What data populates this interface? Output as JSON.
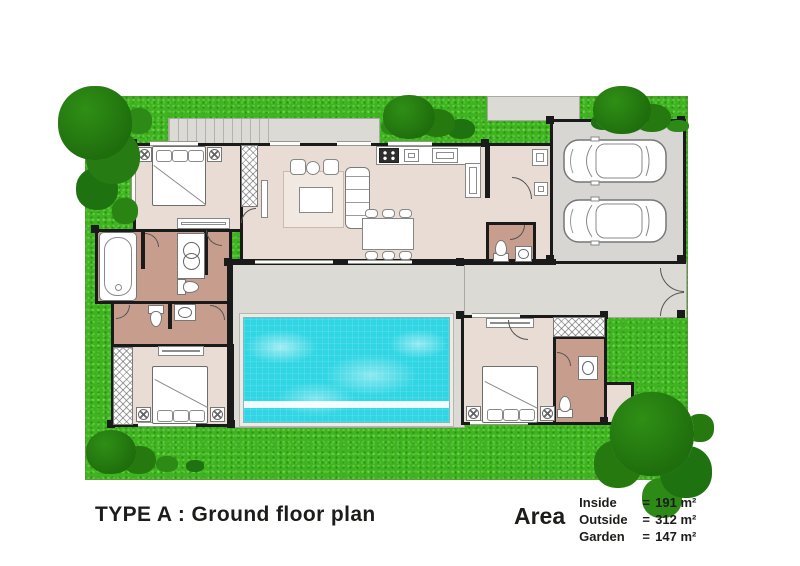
{
  "title": "TYPE A : Ground floor plan",
  "legend": {
    "label": "Area",
    "equals": "=",
    "rows": [
      {
        "name": "Inside",
        "value": "191 m²"
      },
      {
        "name": "Outside",
        "value": "312 m²"
      },
      {
        "name": "Garden",
        "value": "147 m²"
      }
    ]
  },
  "colors": {
    "grass": "#3eb51e",
    "tree_mid": "#2f8f15",
    "tree_dark": "#1f6e0d",
    "pool_water": "#31d6e4",
    "floor": "#e9dcd4",
    "bath_floor": "#c79e8e",
    "deck": "#dbdad5",
    "garage_floor": "#d7d6d2",
    "rug": "#f0e8e1",
    "wall": "#1a1a1a",
    "text": "#1c1c1a"
  },
  "icons": {
    "bedrooms": 3,
    "bathrooms": 4,
    "cars": 2,
    "pool": 1
  }
}
